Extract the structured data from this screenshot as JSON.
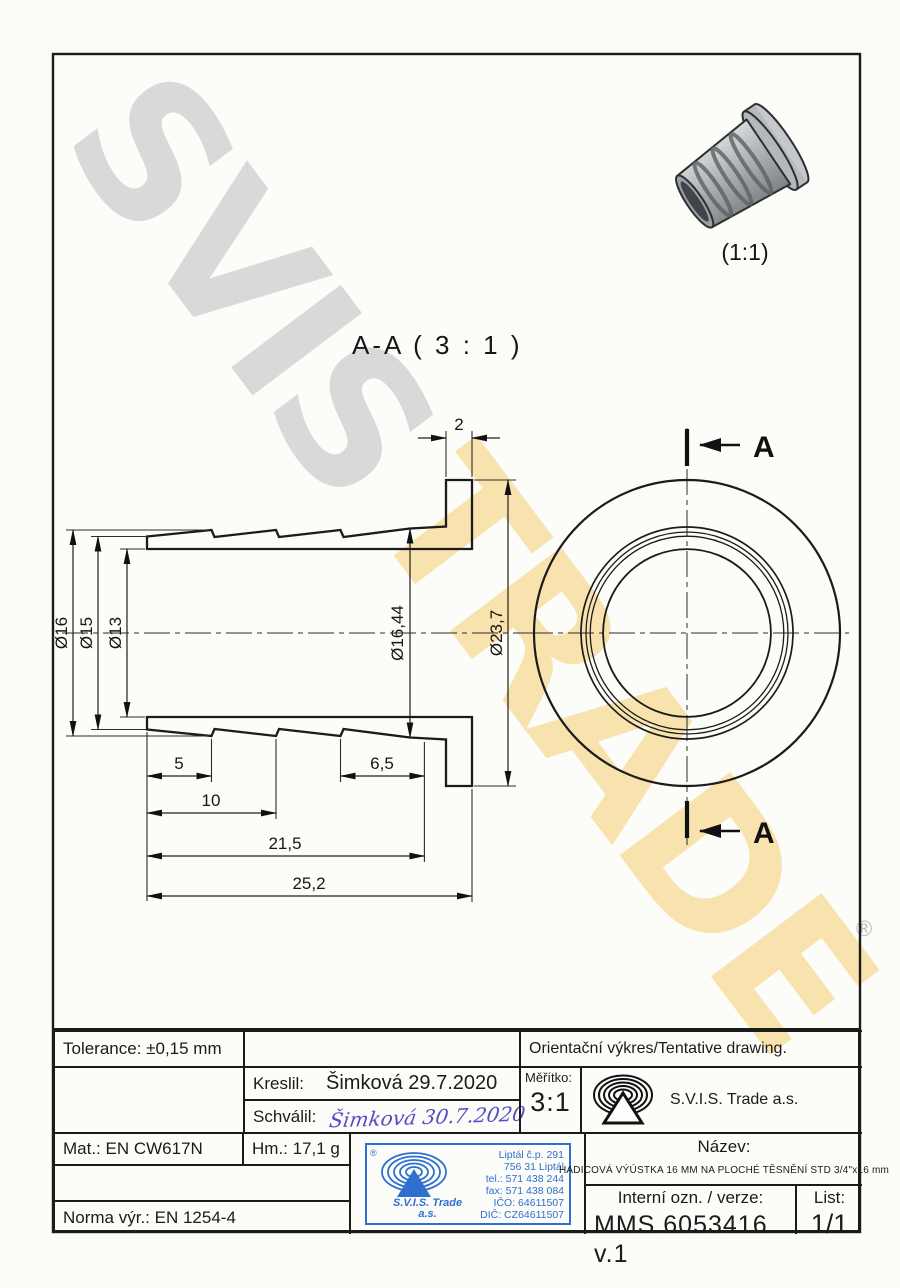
{
  "watermarks": {
    "gray_text": "SVIS",
    "yellow_text": "TRADE",
    "registered_mark": "®"
  },
  "drawing": {
    "detail_view_scale": "(1:1)",
    "section_view_title": "A-A ( 3 : 1 )",
    "section_arrow_label": "A",
    "dims": {
      "od_16": "Ø16",
      "od_15": "Ø15",
      "od_13": "Ø13",
      "od_16_44": "Ø16,44",
      "od_23_7": "Ø23,7",
      "flange_thickness": "2",
      "len_5": "5",
      "len_6_5": "6,5",
      "len_10": "10",
      "len_21_5": "21,5",
      "len_25_2": "25,2"
    }
  },
  "title_block": {
    "tolerance": "Tolerance: ±0,15 mm",
    "orientacni": "Orientační výkres/Tentative drawing.",
    "kreslil_label": "Kreslil:",
    "kreslil_value": "Šimková 29.7.2020",
    "schvalil_label": "Schválil:",
    "schvalil_value": "Šimková 30.7.2020",
    "meritko_label": "Měřítko:",
    "meritko_value": "3:1",
    "company": "S.V.I.S. Trade a.s.",
    "mat": "Mat.: EN CW617N",
    "hm": "Hm.: 17,1 g",
    "norma": "Norma výr.: EN 1254-4",
    "nazev_label": "Název:",
    "nazev_value": "HADICOVÁ VÝÚSTKA 16 MM NA PLOCHÉ TĚSNĚNÍ STD 3/4\"x16 mm",
    "interni_label": "Interní ozn. / verze:",
    "interni_value": "MMS 6053416 v.1",
    "list_label": "List:",
    "list_value": "1/1",
    "stamp": {
      "reg": "®",
      "company_line1": "S.V.I.S. Trade",
      "company_line2": "a.s.",
      "address1": "Liptál č.p. 291",
      "address2": "756 31 Liptál",
      "tel": "tel.: 571 438 244",
      "fax": "fax: 571 438 084",
      "ico": "IČO: 64611507",
      "dic": "DIČ: CZ64611507"
    }
  },
  "colors": {
    "stamp_blue": "#2e6fd0",
    "signature_ink": "#544cc3",
    "watermark_gray": "#d9d9d9",
    "watermark_yellow": "#f3c761",
    "line_black": "#1b1b1b"
  }
}
